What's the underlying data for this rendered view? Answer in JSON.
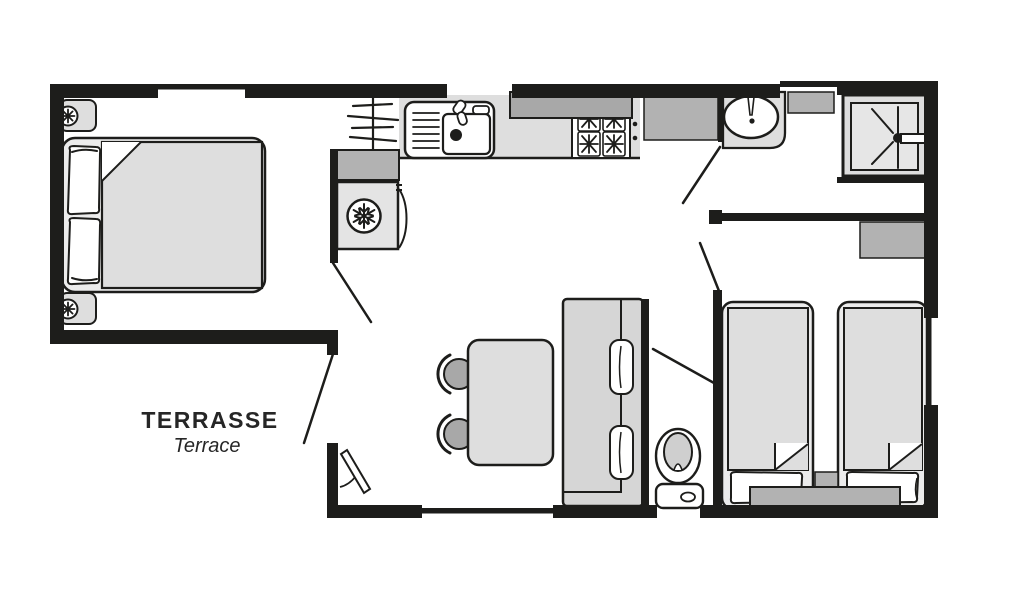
{
  "document": {
    "kind": "floor-plan",
    "description": "Top-down floor plan of a holiday mobile home with double bedroom, kitchen, shower room, WC, twin bedroom, dining area and terrace"
  },
  "labels": {
    "terrace_fr": "TERRASSE",
    "terrace_en": "Terrace"
  },
  "colors": {
    "wall": "#1d1d1b",
    "lt": "#dedede",
    "md": "#b2b2b2",
    "dk": "#a8a8a8",
    "bg": "#ffffff"
  },
  "icons": [
    "double-bed-icon",
    "pillow-icon",
    "nightstand-flower-icon",
    "drying-rack-icon",
    "kitchen-sink-icon",
    "stove-burner-icon",
    "overhead-cabinet-icon",
    "fridge-snowflake-icon",
    "washbasin-icon",
    "shelf-icon",
    "shower-tray-icon",
    "wardrobe-icon",
    "dining-table-icon",
    "chair-icon",
    "sofa-bench-icon",
    "toilet-icon",
    "single-bed-icon",
    "bedside-table-icon",
    "door-swing-icon",
    "window-icon"
  ]
}
